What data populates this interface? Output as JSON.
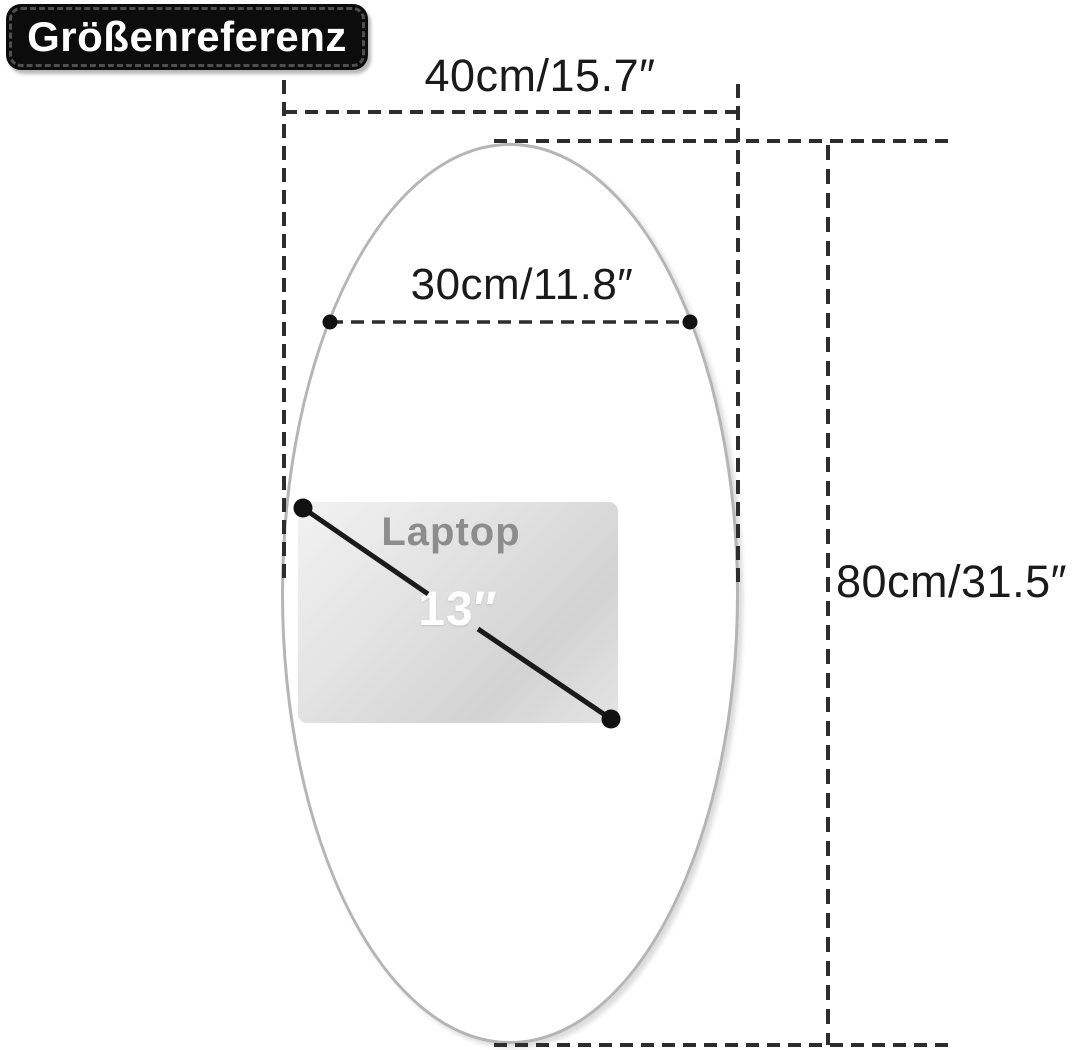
{
  "badge": {
    "label": "Größenreferenz"
  },
  "dimensions": {
    "outer_width": "40cm/15.7″",
    "inner_width": "30cm/11.8″",
    "height": "80cm/31.5″"
  },
  "laptop": {
    "label": "Laptop",
    "diagonal": "13″"
  },
  "colors": {
    "dimension_line": "#2d2d2d",
    "dimension_text": "#1a1a1a",
    "badge_background": "#0c0c0c",
    "badge_border_dash": "#4f4f4f",
    "badge_text": "#ffffff",
    "mirror_stroke": "#b5b5b5",
    "laptop_label_text": "#8d8d8d",
    "laptop_size_text": "#ffffff",
    "marker_dot": "#111111"
  }
}
